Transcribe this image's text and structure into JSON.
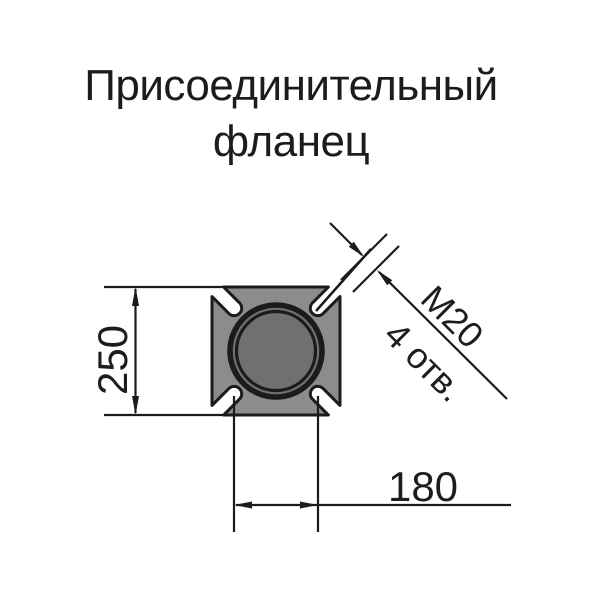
{
  "title": {
    "line1": "Присоединительный",
    "line2": "фланец"
  },
  "dimensions": {
    "flange_height": "250",
    "hole_spacing": "180",
    "bolt_thread": "М20",
    "bolt_hole_count": "4 отв."
  },
  "colors": {
    "flange_body": "#8c8c8e",
    "bore_fill": "#6f7072",
    "line": "#1b1b1c",
    "background": "#ffffff"
  }
}
